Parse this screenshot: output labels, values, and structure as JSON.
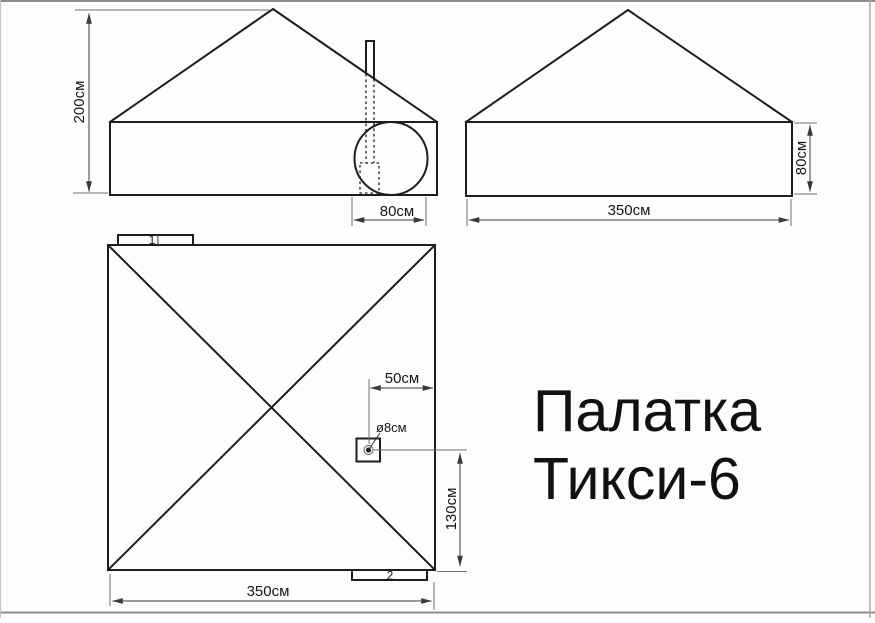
{
  "title": {
    "line1": "Палатка",
    "line2": "Тикси-6"
  },
  "front_view": {
    "height_dim": "200см",
    "entrance_dim": "80см"
  },
  "side_view": {
    "width_dim": "350см",
    "wall_height_dim": "80см"
  },
  "plan_view": {
    "width_dim": "350см",
    "stove_offset_dim": "50см",
    "stove_height_dim": "130см",
    "pipe_diameter_dim": "ø8см",
    "tab1_label": "1",
    "tab2_label": "2"
  },
  "colors": {
    "line": "#1d1d1d",
    "dim": "#3a3a3a",
    "border": "#8d8d8d",
    "background": "#fdfdfd"
  }
}
